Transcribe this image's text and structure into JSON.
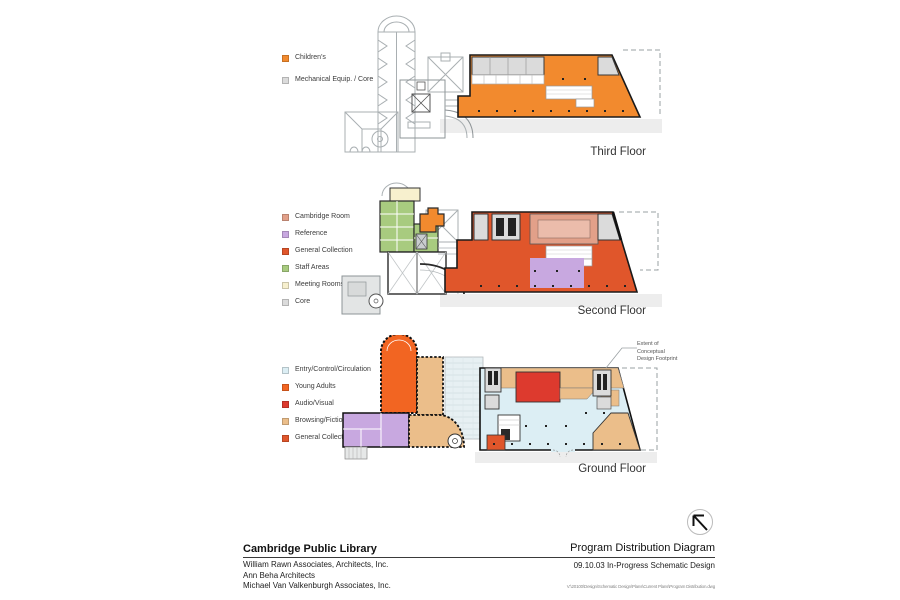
{
  "palette": {
    "childrens": "#F28A2E",
    "mech_core": "#DBDBDB",
    "cambridge_room": "#E2A089",
    "reference": "#C8A8E0",
    "general_collection": "#E0562B",
    "staff_areas": "#A8CB7F",
    "meeting_rooms": "#F7F0CE",
    "core": "#DBDBDB",
    "entry": "#DCEEF4",
    "young_adults": "#F26522",
    "audio_visual": "#DD3A2E",
    "browsing": "#EBBE8A"
  },
  "floors": [
    {
      "label": "Third Floor",
      "legend": [
        {
          "label": "Children's",
          "color": "#F28A2E"
        },
        {
          "label": "Mechanical Equip. / Core",
          "color": "#DBDBDB"
        }
      ]
    },
    {
      "label": "Second Floor",
      "legend": [
        {
          "label": "Cambridge Room",
          "color": "#E2A089"
        },
        {
          "label": "Reference",
          "color": "#C8A8E0"
        },
        {
          "label": "General Collection",
          "color": "#E0562B"
        },
        {
          "label": "Staff Areas",
          "color": "#A8CB7F"
        },
        {
          "label": "Meeting Rooms",
          "color": "#F7F0CE"
        },
        {
          "label": "Core",
          "color": "#DBDBDB"
        }
      ]
    },
    {
      "label": "Ground Floor",
      "legend": [
        {
          "label": "Entry/Control/Circulation",
          "color": "#DCEEF4"
        },
        {
          "label": "Young Adults",
          "color": "#F26522"
        },
        {
          "label": "Audio/Visual",
          "color": "#DD3A2E"
        },
        {
          "label": "Browsing/Fiction",
          "color": "#EBBE8A"
        },
        {
          "label": "General Collection",
          "color": "#E0562B"
        }
      ]
    }
  ],
  "annotation": "Extent of\nConceptual\nDesign Footprint",
  "title_block": {
    "project": "Cambridge Public Library",
    "firms": [
      "William Rawn Associates, Architects, Inc.",
      "Ann Beha Architects",
      "Michael Van Valkenburgh Associates, Inc."
    ],
    "sheet_title": "Program Distribution Diagram",
    "phase": "09.10.03 In-Progress Schematic Design",
    "file_path": "V:\\20100\\Design\\Schematic Design\\Plans\\Current Plans\\Program Distribution.dwg"
  },
  "icons": {
    "north_arrow_icon": "↖"
  }
}
